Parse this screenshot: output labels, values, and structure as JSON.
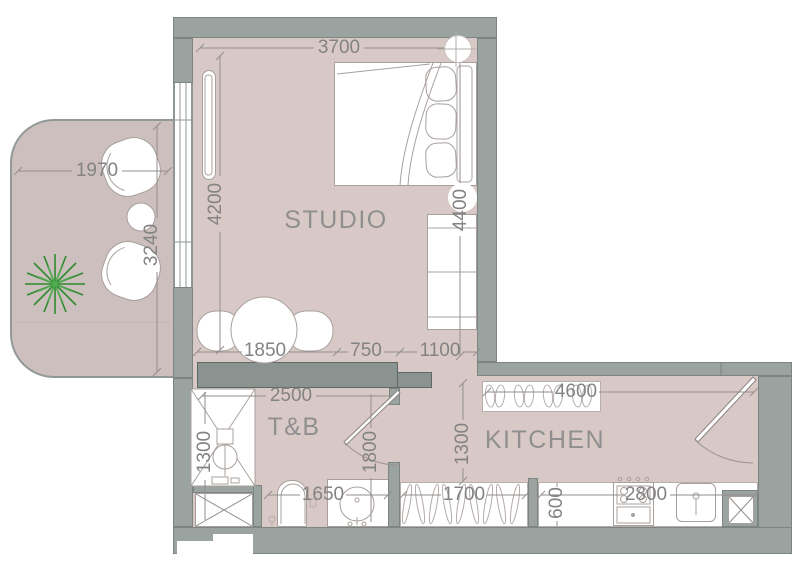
{
  "floorplan": {
    "room_labels": {
      "studio": "STUDIO",
      "toilet_bath": "T&B",
      "kitchen": "KITCHEN"
    },
    "dims": {
      "studio_width": "3700",
      "studio_depth_left": "4200",
      "studio_depth_right": "4400",
      "balcony_width": "1970",
      "balcony_depth": "3240",
      "dining_zone": "1850",
      "walkway": "750",
      "sofa_zone": "1100",
      "tb_width": "2500",
      "shower_depth": "1300",
      "tb_door_side": "1800",
      "tb_counter": "1650",
      "kitchen_width": "4600",
      "corridor_depth": "1300",
      "wardrobe_width": "1700",
      "counter_depth": "600",
      "counter_run": "2800"
    },
    "colors": {
      "floor": "#d9c9c6",
      "balcony_floor": "#cdbfbe",
      "wall": "#9ba3a1",
      "partition": "#8b9391",
      "dimension_text": "#838383",
      "room_label_text": "#8f8f8f",
      "plant_green": "#2e8b2e"
    },
    "icons": {
      "plant": "plant-icon",
      "shower": "shower-icon",
      "toilet": "toilet-icon",
      "sink": "sink-icon",
      "stove": "stove-icon",
      "door_swing": "door-swing-icon"
    }
  }
}
